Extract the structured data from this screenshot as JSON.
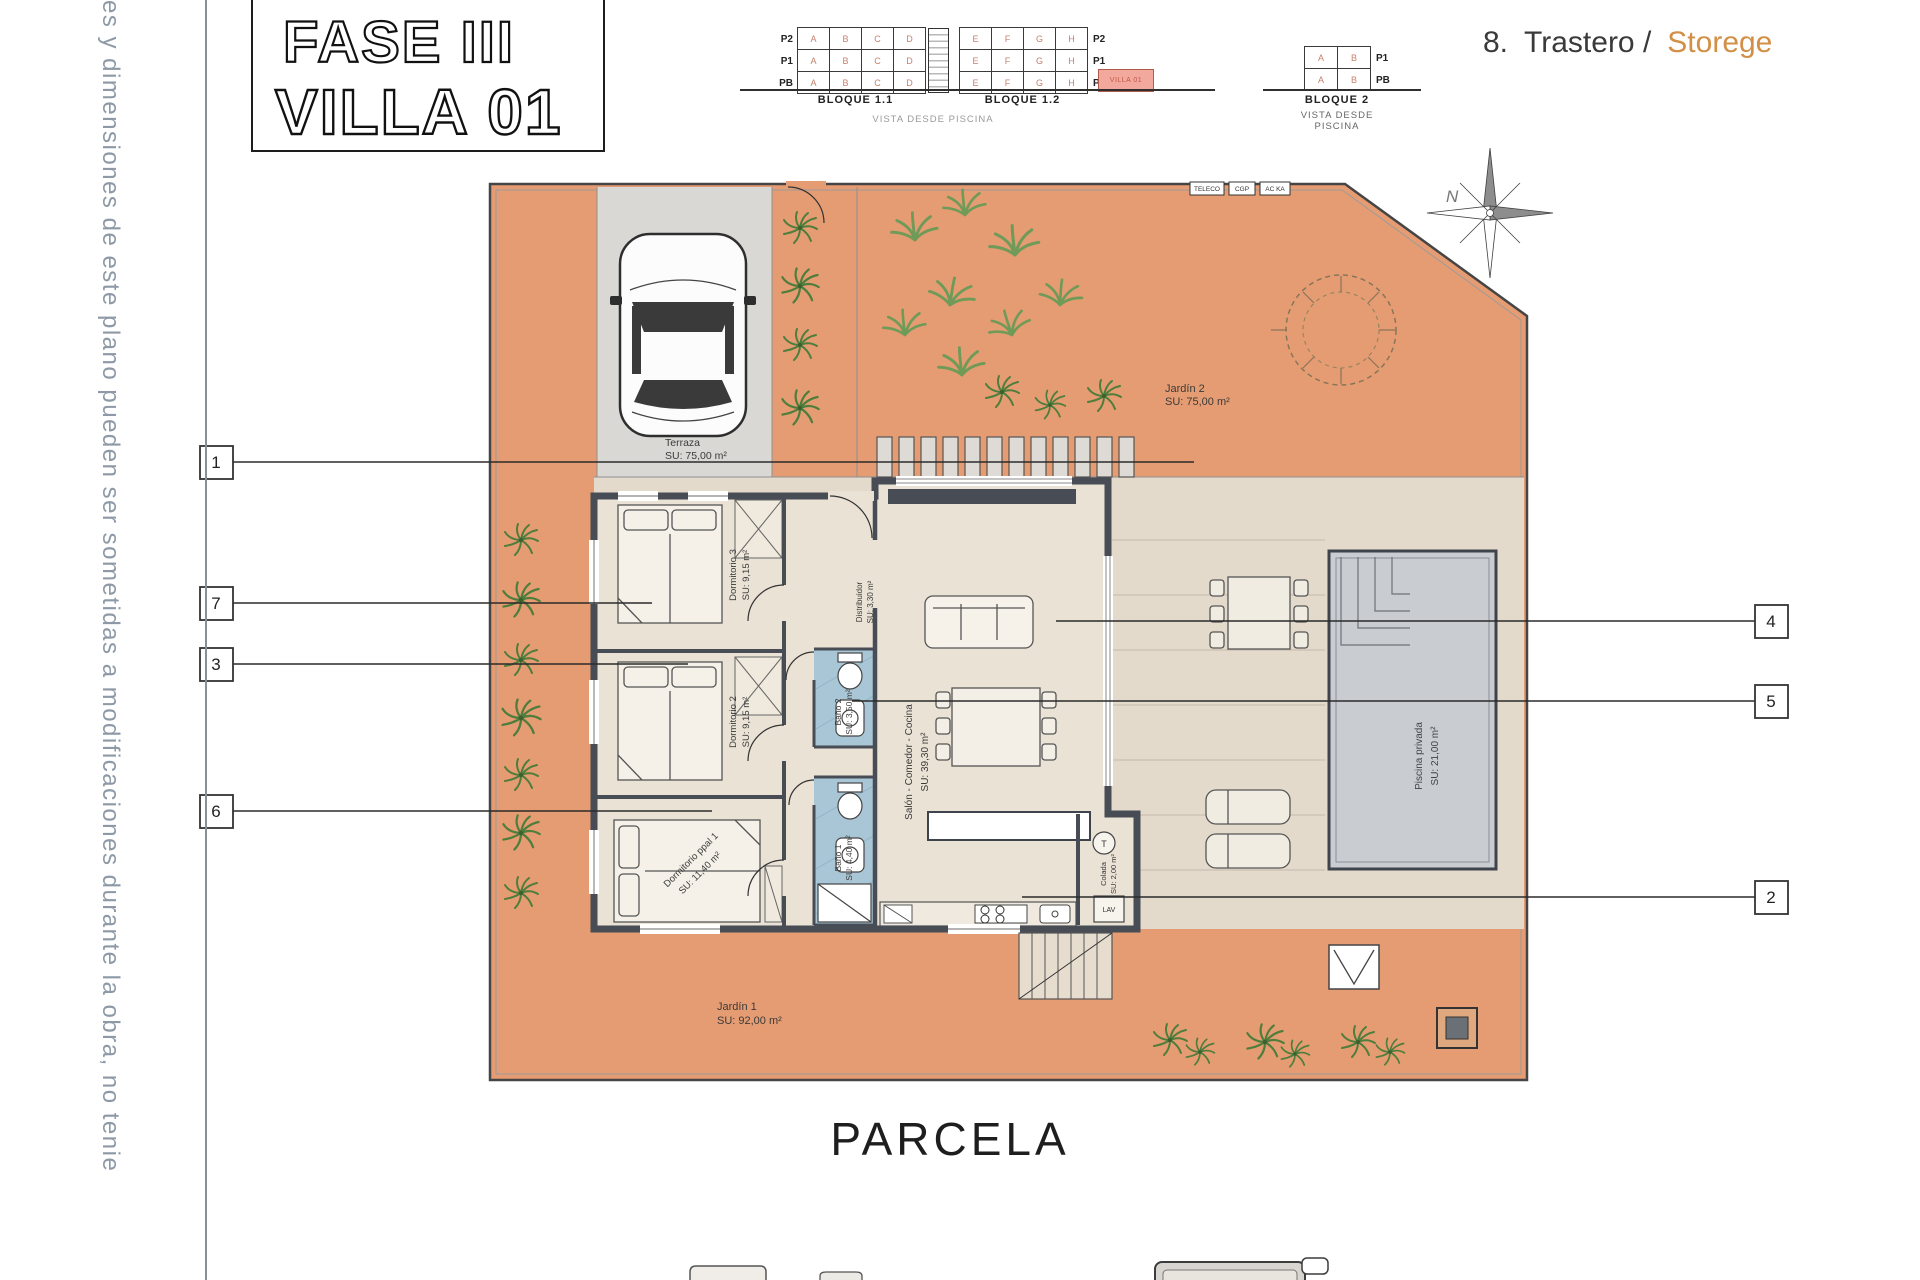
{
  "side_note": "es y dimensiones de este plano pueden ser sometidas a modificaciones durante la obra, no tenie",
  "title": {
    "line1": "FASE III",
    "line2": "VILLA 01"
  },
  "legend": {
    "number": "8.",
    "name": "Trastero /",
    "name_en": "Storege"
  },
  "blocks": {
    "b11": {
      "label": "BLOQUE 1.1",
      "rows": [
        "P2",
        "P1",
        "PB"
      ],
      "units": [
        "A",
        "B",
        "C",
        "D"
      ]
    },
    "b12": {
      "label": "BLOQUE 1.2",
      "rows": [
        "P2",
        "P1",
        "PB"
      ],
      "units": [
        "E",
        "F",
        "G",
        "H"
      ]
    },
    "b2": {
      "label": "BLOQUE 2",
      "rows": [
        "P1",
        "PB"
      ],
      "units": [
        "A",
        "B"
      ]
    },
    "caption": "VISTA DESDE PISCINA",
    "caption2": "VISTA DESDE PISCINA",
    "highlight": "VILLA 01"
  },
  "plan": {
    "parcela": "PARCELA",
    "north": "N",
    "utility_boxes": [
      "TELECO",
      "CGP",
      "AC KA"
    ],
    "heater_label": "T",
    "appliance_label": "LAV",
    "rooms": {
      "terraza": {
        "name": "Terraza",
        "area": "SU: 75,00 m²"
      },
      "jardin2": {
        "name": "Jardín 2",
        "area": "SU: 75,00 m²"
      },
      "jardin1": {
        "name": "Jardín 1",
        "area": "SU: 92,00 m²"
      },
      "dorm3": {
        "name": "Dormitorio 3",
        "area": "SU: 9,15 m²"
      },
      "dorm2": {
        "name": "Dormitorio 2",
        "area": "SU: 9,15 m²"
      },
      "dorm1": {
        "name": "Dormitorio ppal 1",
        "area": "SU: 11,40 m²"
      },
      "bano2": {
        "name": "Baño 2",
        "area": "SU: 3,50 m²"
      },
      "bano1": {
        "name": "Baño 1",
        "area": "SU: 4,40 m²"
      },
      "distribuidor": {
        "name": "Distribuidor",
        "area": "SU: 3,30 m²"
      },
      "salon": {
        "name": "Salón - Comedor - Cocina",
        "area": "SU: 39,30 m²"
      },
      "piscina": {
        "name": "Piscina privada",
        "area": "SU: 21,00 m²"
      },
      "colada": {
        "name": "Colada",
        "area": "SU: 2,00 m²"
      }
    },
    "callouts_left": [
      "1",
      "7",
      "3",
      "6"
    ],
    "callouts_right": [
      "4",
      "5",
      "2"
    ]
  },
  "colors": {
    "terrain_orange": "#e69c72",
    "patio_beige": "#e3dacb",
    "wall_dark": "#474c55",
    "bath_blue": "#a9c6d6",
    "pool_gray": "#c9cdd1",
    "highlight_pink": "#f2a89c",
    "legend_orange": "#d28f45"
  }
}
